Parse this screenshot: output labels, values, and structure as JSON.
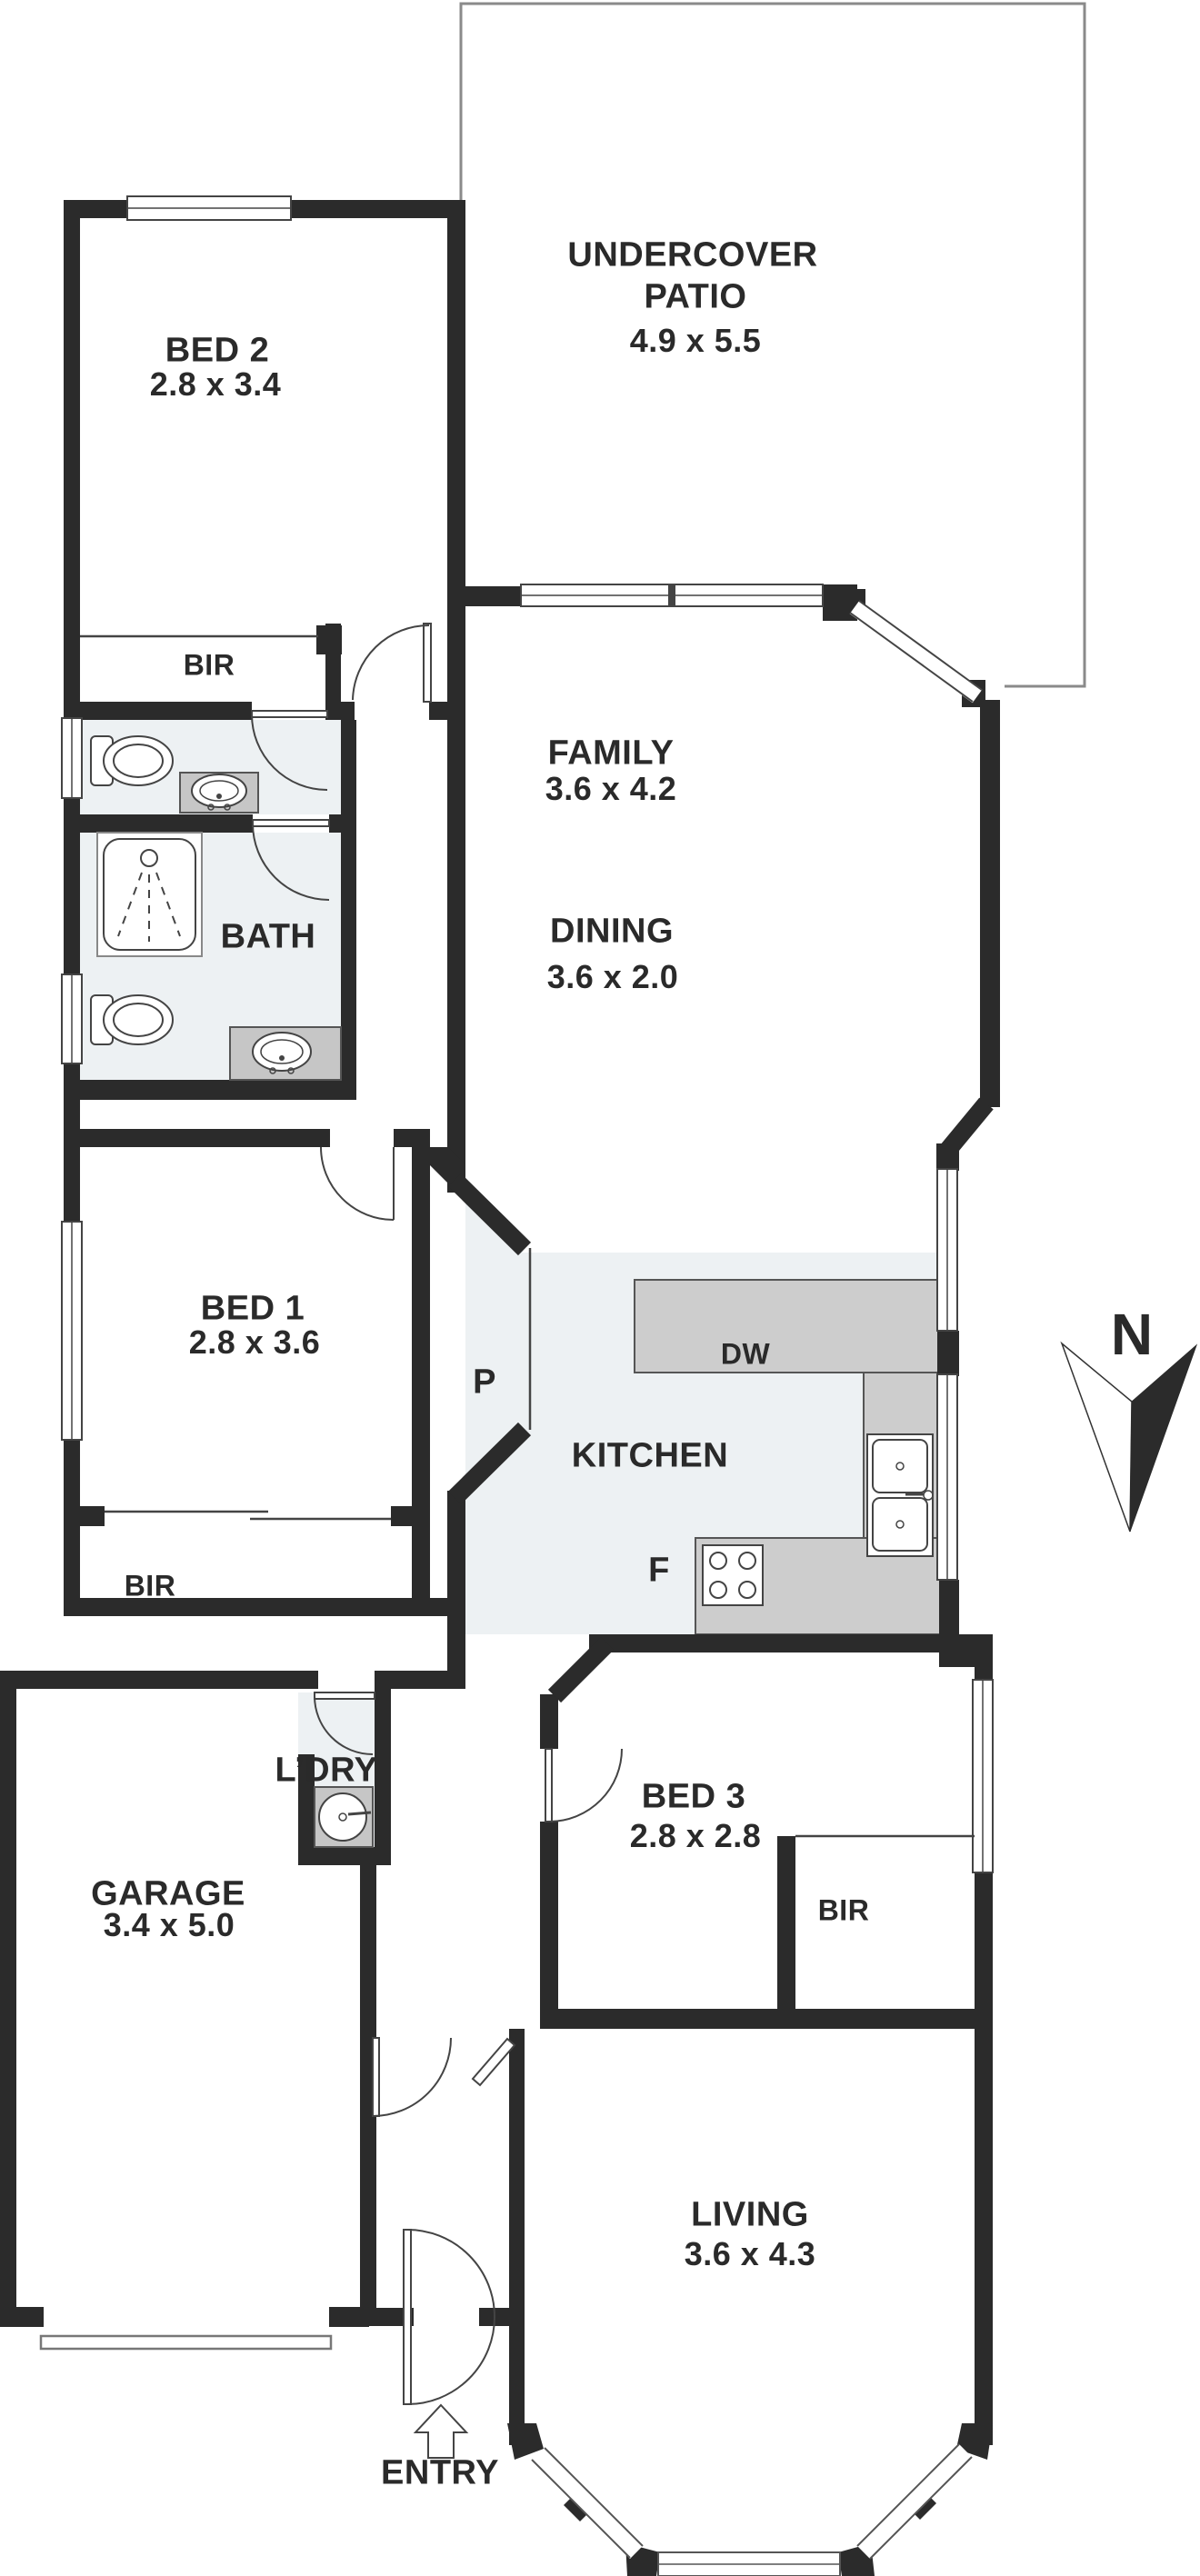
{
  "colors": {
    "wall": "#2b2b2b",
    "wet_area": "#edf1f3",
    "counter": "#cdcdcd",
    "thin_line": "#444444",
    "patio_outline": "#8a8a8a"
  },
  "labels": {
    "patio_line1": "UNDERCOVER",
    "patio_line2": "PATIO",
    "patio_dims": "4.9 x 5.5",
    "bed2": "BED 2",
    "bed2_dims": "2.8 x 3.4",
    "bir_bed2": "BIR",
    "bath": "BATH",
    "family": "FAMILY",
    "family_dims": "3.6 x 4.2",
    "dining": "DINING",
    "dining_dims": "3.6 x 2.0",
    "bed1": "BED 1",
    "bed1_dims": "2.8 x 3.6",
    "pantry": "P",
    "kitchen": "KITCHEN",
    "dishwasher": "DW",
    "fridge": "F",
    "bir_bed1": "BIR",
    "bed3": "BED 3",
    "bed3_dims": "2.8 x 2.8",
    "bir_bed3": "BIR",
    "garage": "GARAGE",
    "garage_dims": "3.4 x 5.0",
    "laundry": "L’DRY",
    "living": "LIVING",
    "living_dims": "3.6 x 4.3",
    "entry": "ENTRY",
    "compass_north": "N"
  }
}
